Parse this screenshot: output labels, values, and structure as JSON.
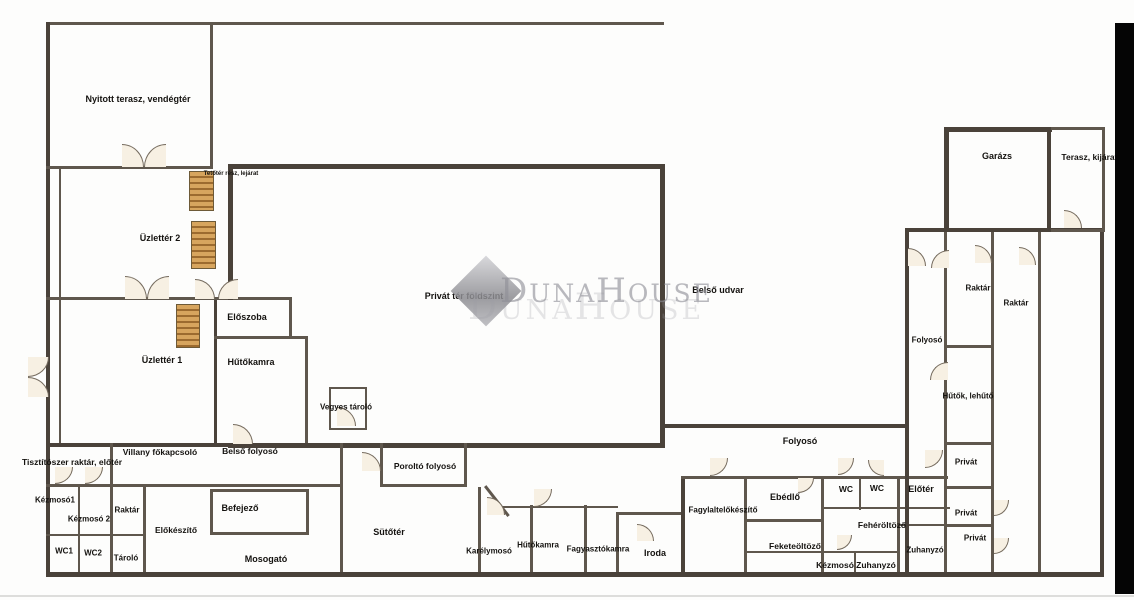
{
  "rooms": {
    "nyitott_terasz": "Nyitott terasz, vendégtér",
    "tetoter_lejarat": "Tetőtér rész, lejárat",
    "uzletter_2": "Üzlettér 2",
    "eloszoba": "Előszoba",
    "uzletter_1": "Üzlettér 1",
    "hutokamra_1": "Hűtőkamra",
    "vegyes_tarolo": "Vegyes tároló",
    "privat_ter": "Privát tér földszint",
    "belso_udvar": "Belső udvar",
    "villany_fokapcsolo": "Villany főkapcsoló",
    "belso_folyoso": "Belső folyosó",
    "tisztitoszer_raktar": "Tisztítószer raktár, előtér",
    "porolto_folyoso": "Poroltó folyosó",
    "kezmoso_1": "Kézmosó1",
    "kezmoso_2": "Kézmosó 2",
    "raktar_bal": "Raktár",
    "elokeszito": "Előkészítő",
    "befejezo": "Befejező",
    "wc_1": "WC1",
    "wc_2": "WC2",
    "tarolo": "Tároló",
    "mosogato": "Mosogató",
    "sutoter": "Sütőtér",
    "karelymoso": "Karélymosó",
    "hutokamra_2": "Hűtőkamra",
    "fagyasztokamra": "Fagyasztókamra",
    "iroda": "Iroda",
    "folyoso_also": "Folyosó",
    "fagylaltelokeszito": "Fagylaltelőkészítő",
    "ebedlo": "Ebédlő",
    "wc_a": "WC",
    "wc_b": "WC",
    "eloter": "Előtér",
    "feketeoltozo": "Feketeöltöző",
    "feheroltozo": "Fehéröltöző",
    "kezmoso_jobb": "Kézmosó",
    "zuhanyzo_a": "Zuhanyzó",
    "zuhanyzo_b": "Zuhanyzó",
    "privat_a": "Privát",
    "privat_b": "Privát",
    "privat_c": "Privát",
    "garazs": "Garázs",
    "terasz_kijarat": "Terasz, kijárat a",
    "raktar_jobb_1": "Raktár",
    "raktar_jobb_2": "Raktár",
    "folyoso_jobb": "Folyosó",
    "hutok_lehuto": "Hűtők, lehűtő"
  },
  "watermark": {
    "d": "D",
    "una": "UNA",
    "h": "H",
    "ouse": "OUSE"
  },
  "colors": {
    "wall": "#4a423a",
    "door_fill": "#f7f0e3",
    "stairs_wood": "#d7a55e",
    "watermark_gray": "#8f8f97"
  }
}
